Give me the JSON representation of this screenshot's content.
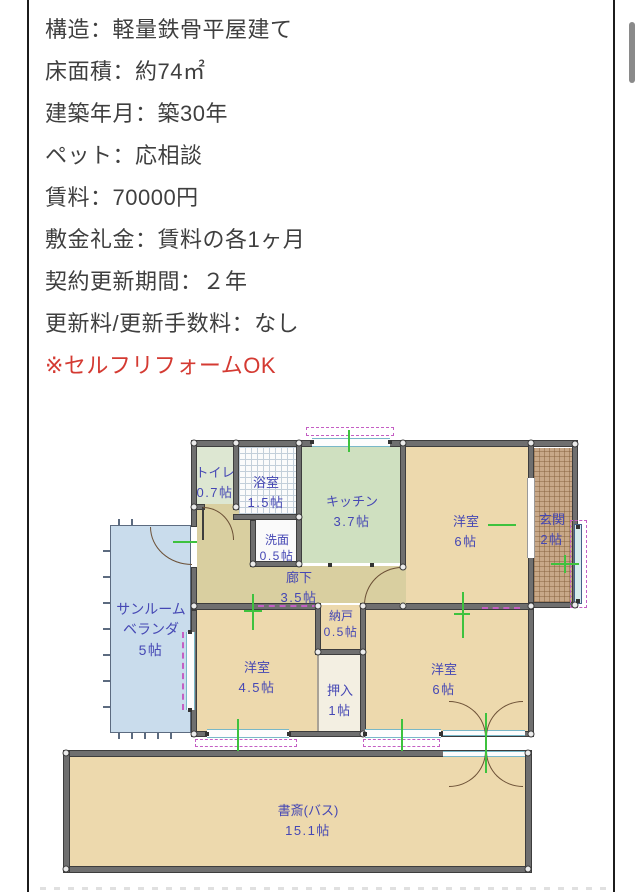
{
  "property_details": {
    "lines": [
      "構造：軽量鉄骨平屋建て",
      "床面積：約74㎡",
      "建築年月：築30年",
      "ペット：応相談",
      "賃料：70000円",
      "敷金礼金：賃料の各1ヶ月",
      "契約更新期間：２年",
      "更新料/更新手数料：なし"
    ],
    "note": "※セルフリフォームOK",
    "text_color": "#3f3f3f",
    "note_color": "#d43a32"
  },
  "floorplan": {
    "rooms": [
      {
        "id": "toilet",
        "name": "トイレ",
        "size": "0.7帖"
      },
      {
        "id": "bath",
        "name": "浴室",
        "size": "1.5帖"
      },
      {
        "id": "kitchen",
        "name": "キッチン",
        "size": "3.7帖"
      },
      {
        "id": "west-room-ne",
        "name": "洋室",
        "size": "6帖"
      },
      {
        "id": "entrance",
        "name": "玄関",
        "size": "2帖"
      },
      {
        "id": "washroom",
        "name": "洗面",
        "size": "0.5帖"
      },
      {
        "id": "hallway",
        "name": "廊下",
        "size": "3.5帖"
      },
      {
        "id": "sunroom",
        "name": "サンルーム",
        "name2": "ベランダ",
        "size": "5帖"
      },
      {
        "id": "storage",
        "name": "納戸",
        "size": "0.5帖"
      },
      {
        "id": "west-room-sw",
        "name": "洋室",
        "size": "4.5帖"
      },
      {
        "id": "closet",
        "name": "押入",
        "size": "1帖"
      },
      {
        "id": "west-room-se",
        "name": "洋室",
        "size": "6帖"
      },
      {
        "id": "study",
        "name": "書斎(バス)",
        "size": "15.1帖"
      }
    ],
    "colors": {
      "label_blue": "#4547b4",
      "wall_gray": "#6f6f6f",
      "room_tan": "#edd9ad",
      "kitchen_green": "#cfe0c0",
      "toilet_green": "#dde7d2",
      "hallway_khaki": "#d9cfa0",
      "sunroom_blue": "#c9dcec",
      "entrance_tile": "#c8a888",
      "closet_white": "#f3efe2",
      "marker_green": "#3ec23e",
      "annotation_pink": "#c45fc4",
      "window_cyan": "#79b8c8"
    }
  },
  "scrollbar": {
    "thumb_color": "#8a8a8a"
  }
}
